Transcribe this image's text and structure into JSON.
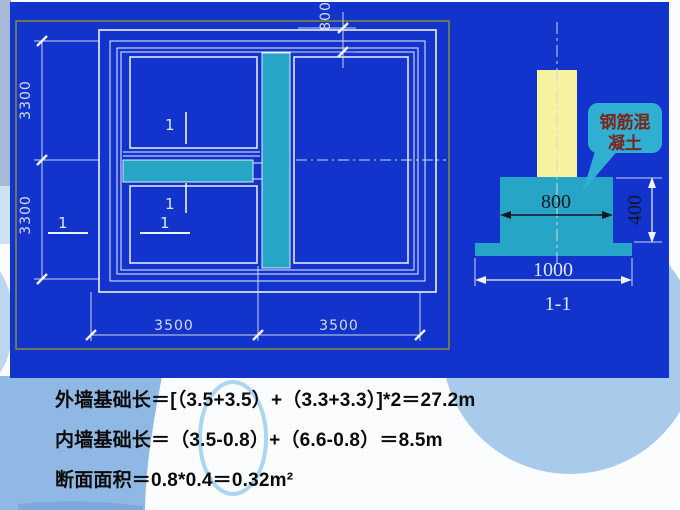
{
  "plan": {
    "mark": "1",
    "dims": {
      "top": "800",
      "left_upper": "3300",
      "left_lower": "3300",
      "bottom_left": "3500",
      "bottom_right": "3500"
    }
  },
  "section": {
    "title": "1-1",
    "dims": {
      "width": "800",
      "height": "400",
      "base": "1000"
    },
    "callout": {
      "line1": "钢筋混",
      "line2": "凝土"
    }
  },
  "calculations": {
    "line1": "外墙基础长＝[（3.5+3.5）+（3.3+3.3）]*2＝27.2m",
    "line2": "内墙基础长＝（3.5-0.8）+（6.6-0.8）＝8.5m",
    "line3": "断面面积＝0.8*0.4＝0.32m²"
  },
  "colors": {
    "panel_blue": "#1233cc",
    "foundation_cyan": "#27a5c7",
    "column_yellow": "#f7f2a0",
    "olive_border": "#8a8c33",
    "callout_text": "#7c241c",
    "decor_light_blue": "#a8cbec",
    "decor_medium_blue": "#8fb8e4"
  }
}
